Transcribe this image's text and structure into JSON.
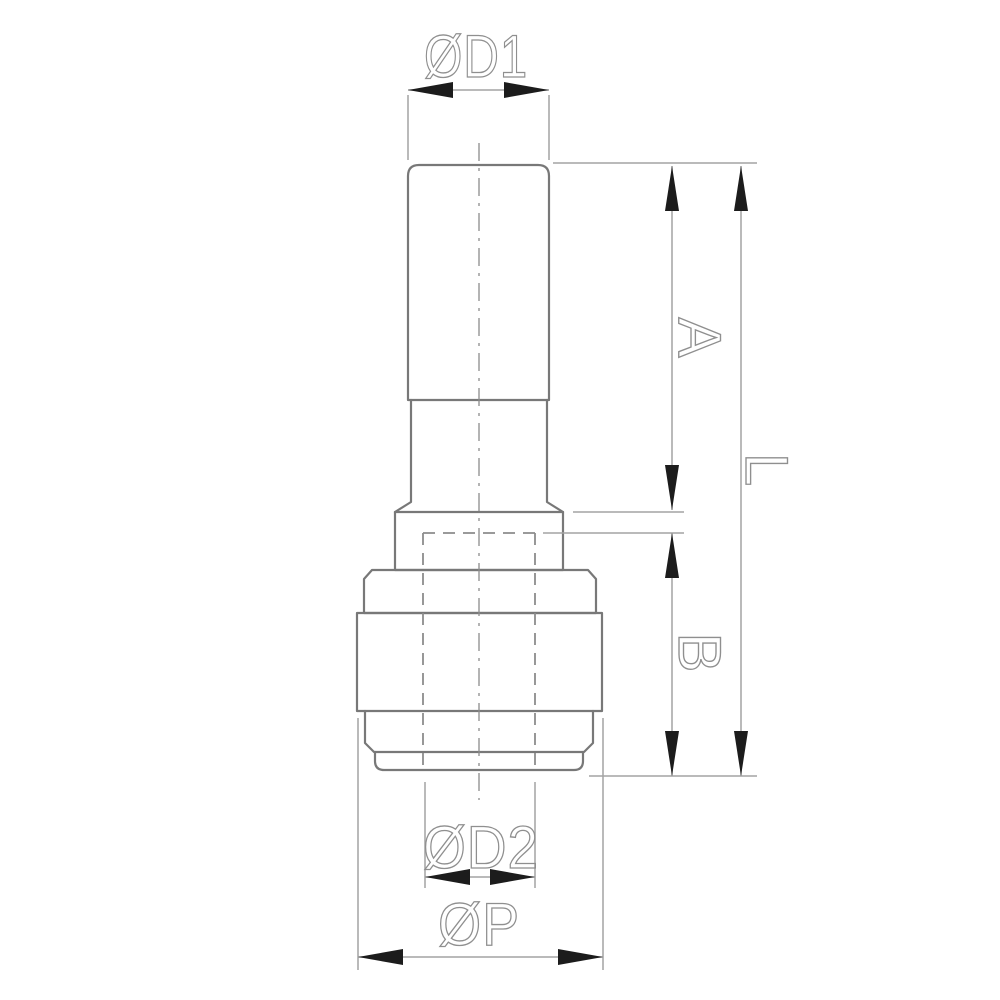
{
  "drawing": {
    "description": "technical-drawing-pneumatic-reducer-fitting-side-view",
    "labels": {
      "d1": "ØD1",
      "a": "A",
      "l": "L",
      "b": "B",
      "d2": "ØD2",
      "p": "ØP"
    },
    "colors": {
      "background": "#ffffff",
      "outline": "#787878",
      "dim_line": "#a3a3a3",
      "hidden": "#8c8c8c",
      "arrow": "#1c1c1c",
      "text": "#8f8f8f"
    }
  }
}
